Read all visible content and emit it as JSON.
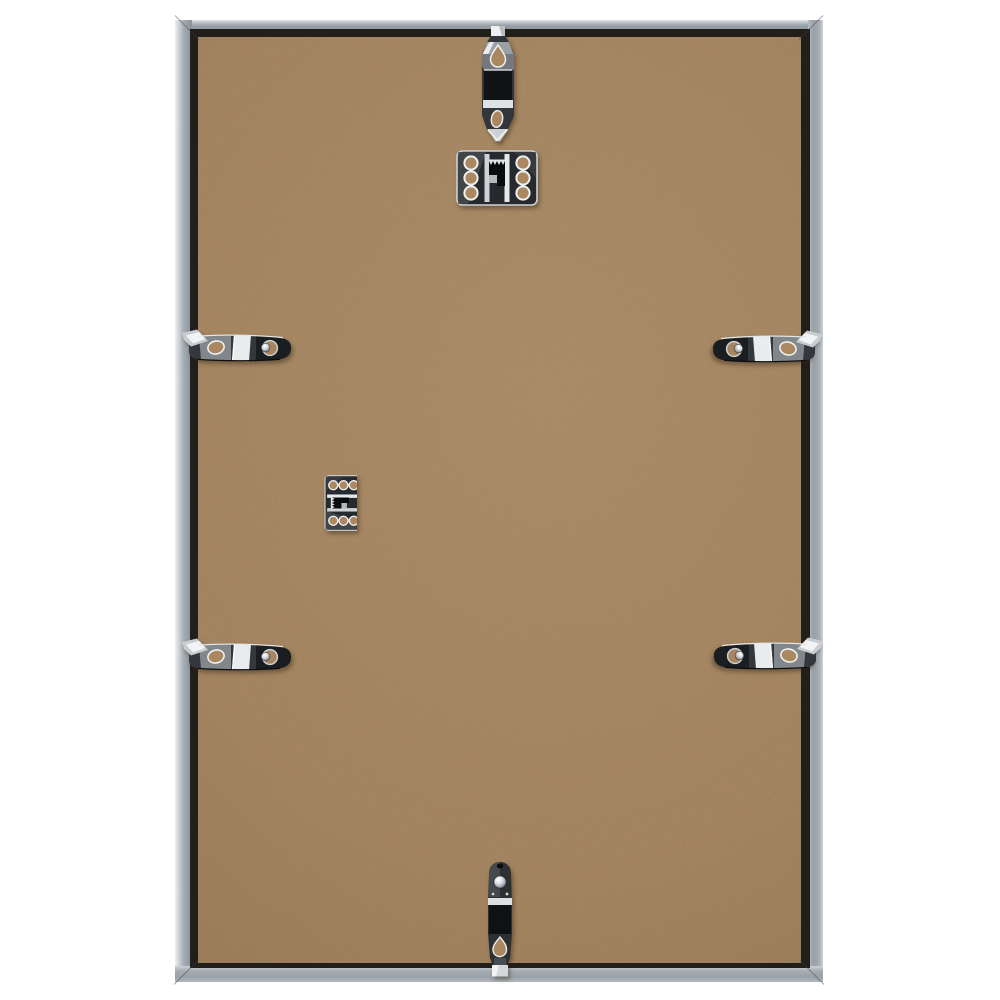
{
  "page": {
    "kind": "product-photo",
    "description": "Rear view of a slim silver aluminium picture frame standing against a white background",
    "background_color": "#ffffff"
  },
  "frame": {
    "label": "aluminium picture frame, back side",
    "finish": "matt silver aluminium profile",
    "color": "#9aa1a8",
    "highlight_color": "#d4d8db",
    "inner_shadow_color": "#221e19"
  },
  "backing_board": {
    "label": "MDF hardboard backing panel",
    "material": "speckled brown MDF hardboard",
    "color": "#a5845e",
    "speckle_dark_color": "#7c5f42",
    "speckle_light_color": "#c4a77c"
  },
  "hardware": {
    "finish": "polished nickel / chrome",
    "metal_bright_color": "#eef0f1",
    "metal_dark_color": "#17191c",
    "spring_clips": [
      {
        "label": "spring clip hooked over top rail",
        "edge": "top",
        "orientation": "vertical"
      },
      {
        "label": "spring clip hooked over left rail, upper",
        "edge": "left",
        "orientation": "horizontal"
      },
      {
        "label": "spring clip hooked over right rail, upper",
        "edge": "right",
        "orientation": "horizontal"
      },
      {
        "label": "spring clip hooked over left rail, lower",
        "edge": "left",
        "orientation": "horizontal"
      },
      {
        "label": "spring clip hooked over right rail, lower",
        "edge": "right",
        "orientation": "horizontal"
      },
      {
        "label": "spring clip hooked over bottom rail",
        "edge": "bottom",
        "orientation": "vertical"
      }
    ],
    "sawtooth_hangers": [
      {
        "label": "sawtooth hanger plate for portrait hanging, top centre",
        "orientation": "horizontal",
        "holes": 6
      },
      {
        "label": "sawtooth hanger plate for landscape hanging, centre left",
        "orientation": "vertical",
        "holes": 6
      }
    ]
  }
}
